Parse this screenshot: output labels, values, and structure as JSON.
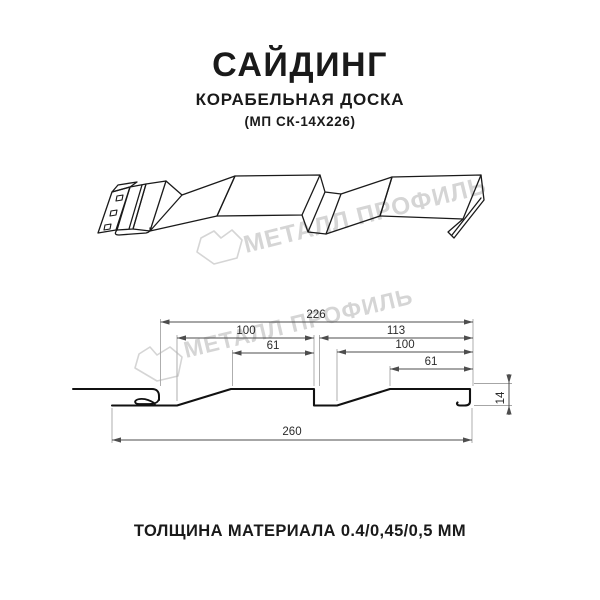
{
  "header": {
    "title": "САЙДИНГ",
    "subtitle": "КОРАБЕЛЬНАЯ ДОСКА",
    "model": "(МП СК-14Х226)"
  },
  "watermark": {
    "brand": "МЕТАЛЛ ПРОФИЛЬ",
    "color": "#d5d5d5",
    "logo_icon": "metal-profil-badge"
  },
  "diagram": {
    "description": "3D line view and cross-section of ship-lap siding panel with perforated mounting flange",
    "dimensions_mm": {
      "coverage_width": "226",
      "board1_width": "100",
      "board1_flat": "61",
      "board2_pitch": "113",
      "board2_width": "100",
      "board2_flat": "61",
      "total_width": "260",
      "profile_height": "14"
    }
  },
  "footer": {
    "thickness_note": "ТОЛЩИНА МАТЕРИАЛА 0.4/0,45/0,5 ММ"
  },
  "colors": {
    "line": "#1a1a1a",
    "dimension": "#4d4d4d",
    "extension": "#a6a6a6",
    "watermark": "#d5d5d5"
  }
}
